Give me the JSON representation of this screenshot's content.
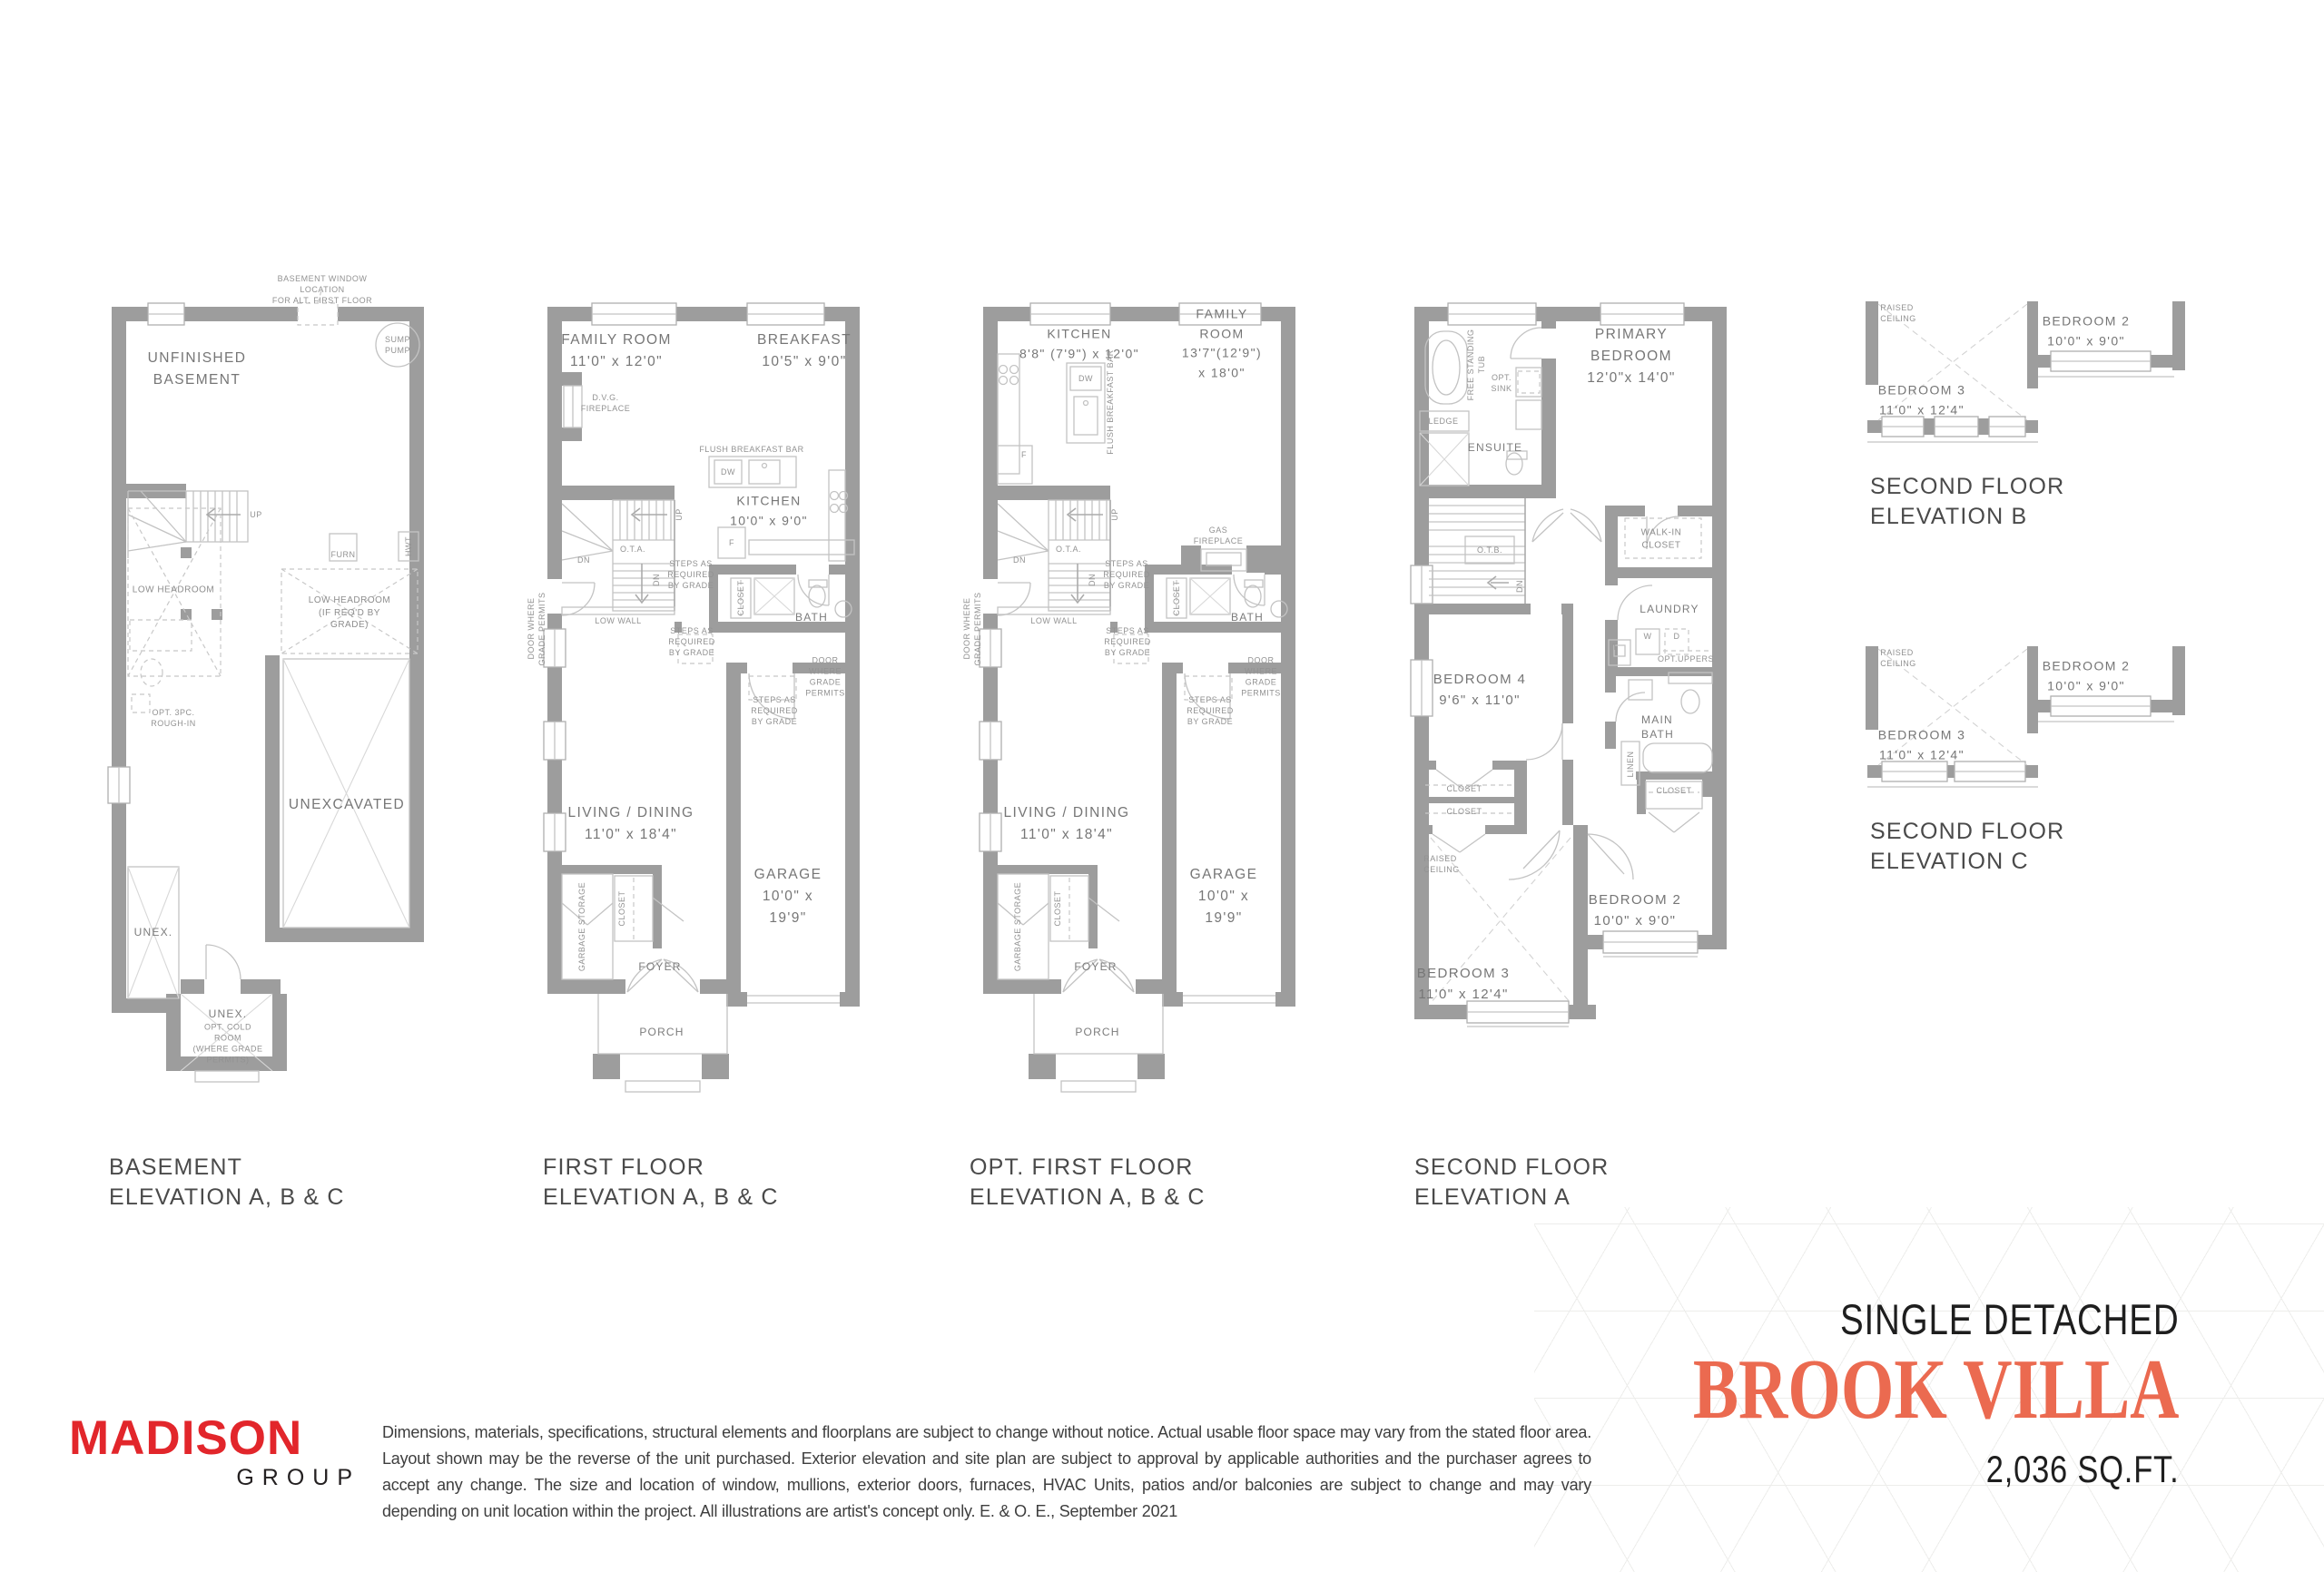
{
  "brand": {
    "name": "MADISON",
    "division": "GROUP",
    "logo_color": "#E2262B"
  },
  "hero": {
    "type_label": "SINGLE DETACHED",
    "model_name": "BROOK VILLA",
    "model_color": "#EB6A50",
    "area_label": "2,036 SQ.FT."
  },
  "disclaimer": "Dimensions, materials, specifications, structural elements and floorplans are subject to change without notice. Actual usable floor space may vary from the stated floor area. Layout shown may be the reverse of the unit purchased. Exterior elevation and site plan are subject to approval by applicable authorities and the purchaser agrees to accept any change. The size and location of window, mullions, exterior doors, furnaces, HVAC Units, patios and/or balconies are subject to change and may vary depending on unit location within the project. All illustrations are artist's concept only. E. & O. E., September 2021",
  "titles": {
    "basement": "BASEMENT\nELEVATION A, B & C",
    "first": "FIRST FLOOR\nELEVATION A, B & C",
    "opt_first": "OPT. FIRST FLOOR\nELEVATION A, B & C",
    "second_a": "SECOND FLOOR\nELEVATION A",
    "second_b": "SECOND FLOOR\nELEVATION B",
    "second_c": "SECOND FLOOR\nELEVATION C"
  },
  "basement": {
    "window_note": "BASEMENT WINDOW LOCATION\nFOR ALT. FIRST FLOOR",
    "room": "UNFINISHED\nBASEMENT",
    "sump": "SUMP\nPUMP",
    "up": "UP",
    "furn": "FURN",
    "hwt": "HWT",
    "low_headroom": "LOW HEADROOM",
    "low_headroom_grade": "LOW HEADROOM\n(IF REQ'D BY GRADE)",
    "rough_in": "OPT. 3PC.\nROUGH-IN",
    "unexcavated": "UNEXCAVATED",
    "unex1": "UNEX.",
    "unex2": "UNEX.",
    "cold_room": "OPT. COLD\nROOM\n(WHERE GRADE\nPERMITS)"
  },
  "first": {
    "family": "FAMILY ROOM\n11'0\" x 12'0\"",
    "breakfast": "BREAKFAST\n10'5\" x 9'0\"",
    "dvg": "D.V.G.\nFIREPLACE",
    "flush_bar": "FLUSH BREAKFAST BAR",
    "dw": "DW",
    "f": "F",
    "kitchen": "KITCHEN\n10'0\" x 9'0\"",
    "ota": "O.T.A.",
    "dn": "DN",
    "dn2": "DN",
    "up": "UP",
    "steps1": "STEPS AS\nREQUIRED\nBY GRADE",
    "steps2": "STEPS AS\nREQUIRED\nBY GRADE",
    "steps3": "STEPS AS\nREQUIRED\nBY GRADE",
    "closet1": "CLOSET",
    "bath": "BATH",
    "low_wall": "LOW WALL",
    "door_grade_left": "DOOR WHERE\nGRADE PERMITS",
    "door_grade_right": "DOOR WHERE\nGRADE PERMITS",
    "living": "LIVING / DINING\n11'0\" x 18'4\"",
    "garbage": "GARBAGE STORAGE",
    "closet2": "CLOSET",
    "foyer": "FOYER",
    "garage": "GARAGE\n10'0\" x 19'9\"",
    "porch": "PORCH"
  },
  "opt_first": {
    "kitchen": "KITCHEN\n8'8\" (7'9\") x 12'0\"",
    "family": "FAMILY ROOM\n13'7\"(12'9\") x 18'0\"",
    "dw": "DW",
    "f": "F",
    "flush_bar": "FLUSH BREAKFAST BAR",
    "gas_fp": "GAS\nFIREPLACE",
    "ota": "O.T.A.",
    "dn": "DN",
    "dn2": "DN",
    "up": "UP",
    "steps1": "STEPS AS\nREQUIRED\nBY GRADE",
    "steps2": "STEPS AS\nREQUIRED\nBY GRADE",
    "steps3": "STEPS AS\nREQUIRED\nBY GRADE",
    "closet1": "CLOSET",
    "bath": "BATH",
    "low_wall": "LOW WALL",
    "door_grade_left": "DOOR WHERE\nGRADE PERMITS",
    "door_grade_right": "DOOR WHERE\nGRADE PERMITS",
    "living": "LIVING / DINING\n11'0\" x 18'4\"",
    "garbage": "GARBAGE STORAGE",
    "closet2": "CLOSET",
    "foyer": "FOYER",
    "garage": "GARAGE\n10'0\" x 19'9\"",
    "porch": "PORCH"
  },
  "second_a": {
    "primary": "PRIMARY BEDROOM\n12'0\"x 14'0\"",
    "tub": "FREE STANDING\nTUB",
    "opt_sink": "OPT.\nSINK",
    "ledge": "LEDGE",
    "ensuite": "ENSUITE",
    "otb": "O.T.B.",
    "dn": "DN",
    "wic": "WALK-IN\nCLOSET",
    "laundry": "LAUNDRY",
    "w": "W",
    "d": "D",
    "t": "T",
    "opt_uppers": "OPT.UPPERS",
    "main_bath": "MAIN\nBATH",
    "linen": "LINEN",
    "closet_b2": "CLOSET",
    "closet1": "CLOSET",
    "closet2": "CLOSET",
    "bed4": "BEDROOM 4\n9'6\" x 11'0\"",
    "raised": "RAISED\nCEILING",
    "bed2": "BEDROOM 2\n10'0\" x 9'0\"",
    "bed3": "BEDROOM 3\n11'0\" x 12'4\""
  },
  "second_b": {
    "raised": "RAISED\nCEILING",
    "bed3": "BEDROOM 3\n11'0\" x 12'4\"",
    "bed2": "BEDROOM 2\n10'0\" x 9'0\""
  },
  "second_c": {
    "raised": "RAISED\nCEILING",
    "bed3": "BEDROOM 3\n11'0\" x 12'4\"",
    "bed2": "BEDROOM 2\n10'0\" x 9'0\""
  }
}
